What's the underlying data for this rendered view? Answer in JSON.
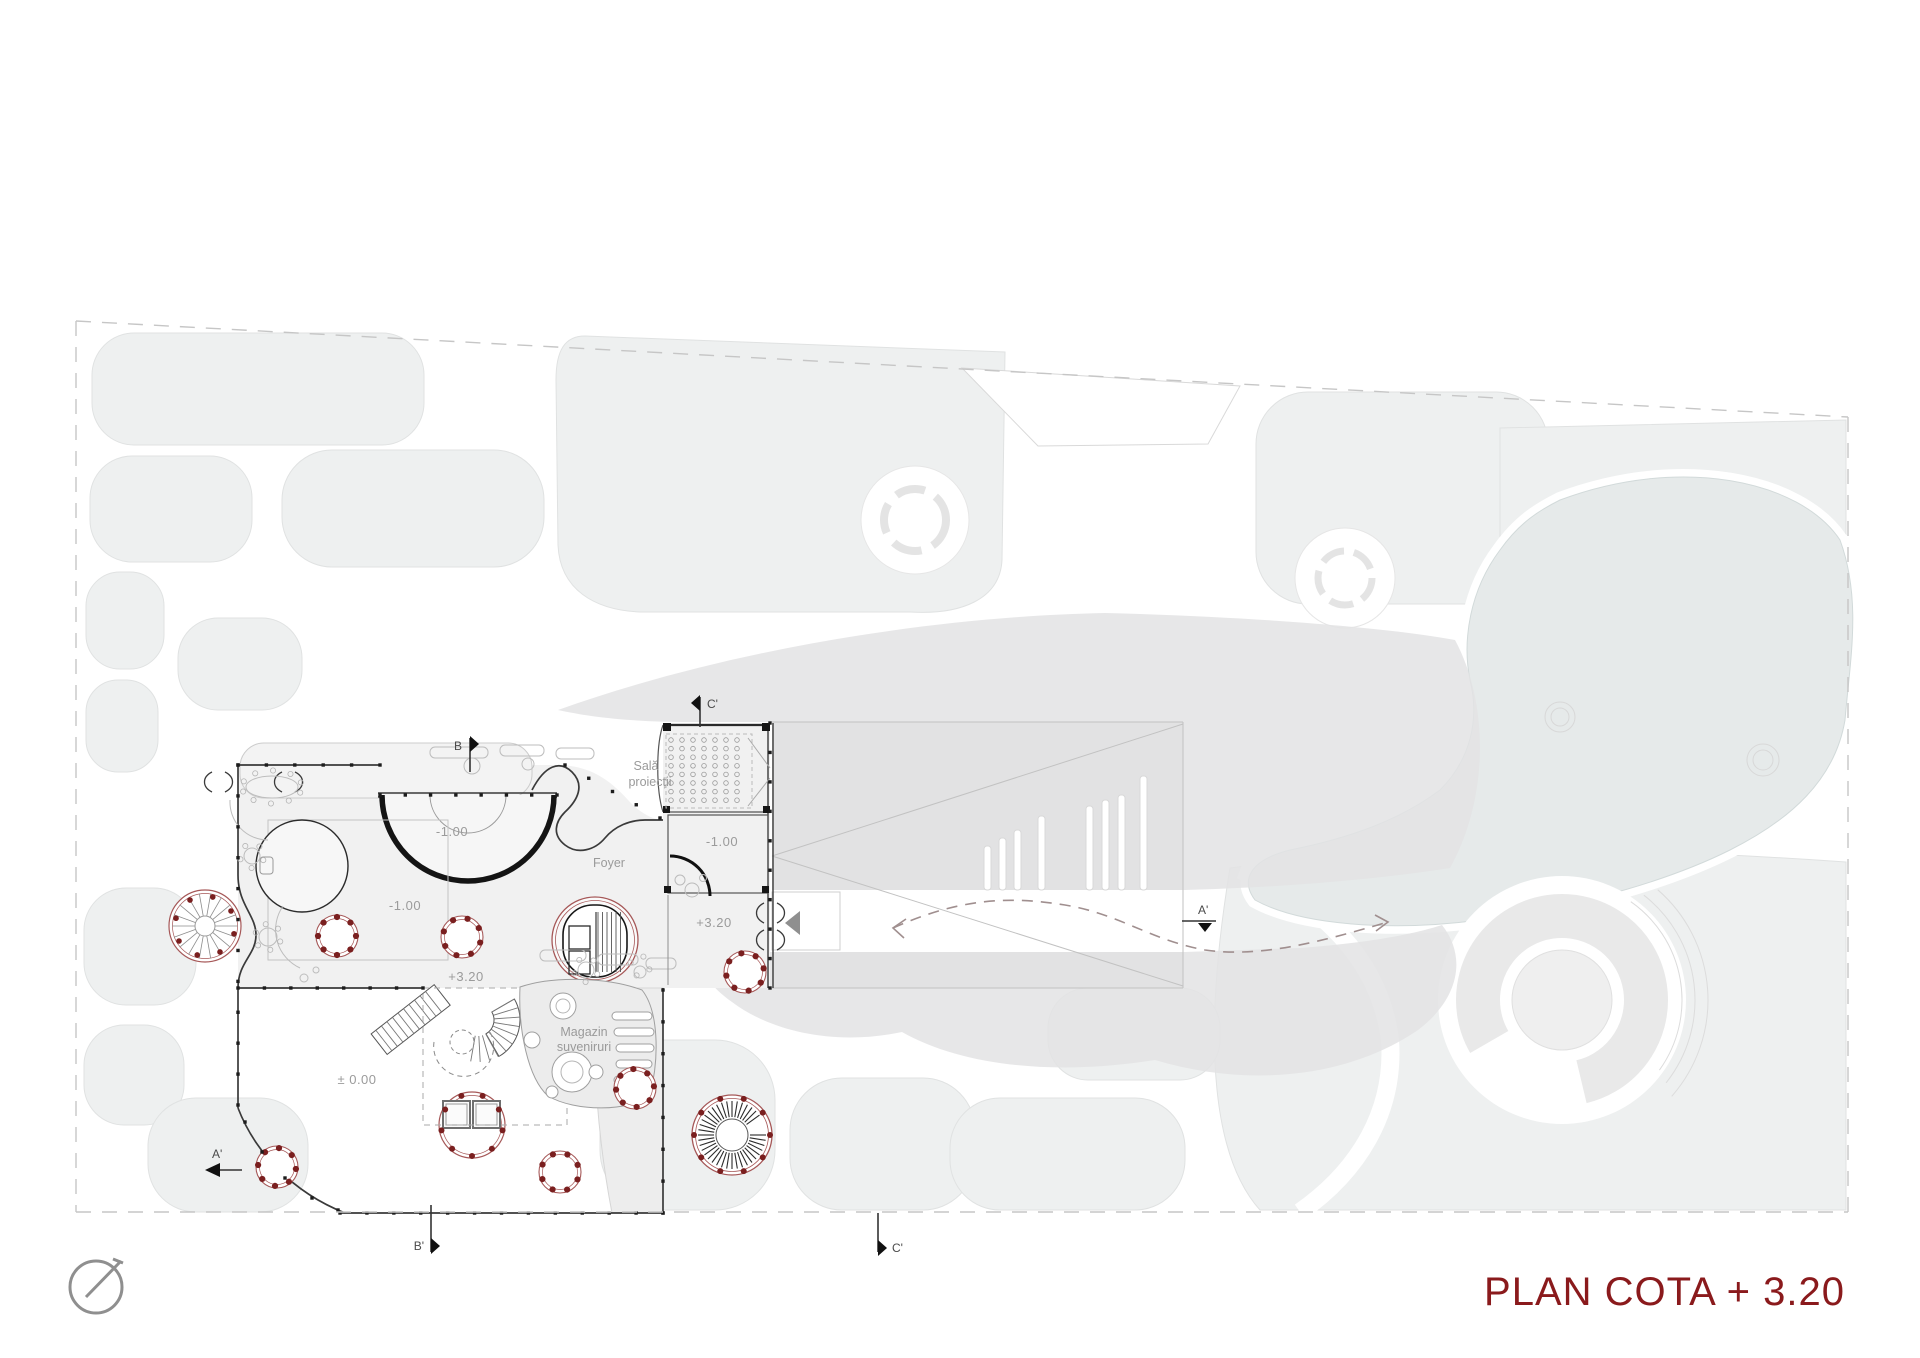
{
  "meta": {
    "sheet_type": "architectural floor plan"
  },
  "title": {
    "text": "PLAN COTA + 3.20",
    "color": "#8a1a1c"
  },
  "north_arrow": {
    "icon": "north-arrow-icon"
  },
  "room_labels": {
    "foyer": "Foyer",
    "sala_line1": "Sală",
    "sala_line2": "proiecții",
    "magazin_line1": "Magazin",
    "magazin_line2": "suveniruri"
  },
  "level_labels": {
    "minus100": "-1.00",
    "plus320": "+3.20",
    "zero": "± 0.00"
  },
  "section_markers": {
    "b_top": "B",
    "b_bottom": "B'",
    "c_top": "C'",
    "c_bottom": "C'",
    "a_left": "A'",
    "a_right": "A'"
  }
}
